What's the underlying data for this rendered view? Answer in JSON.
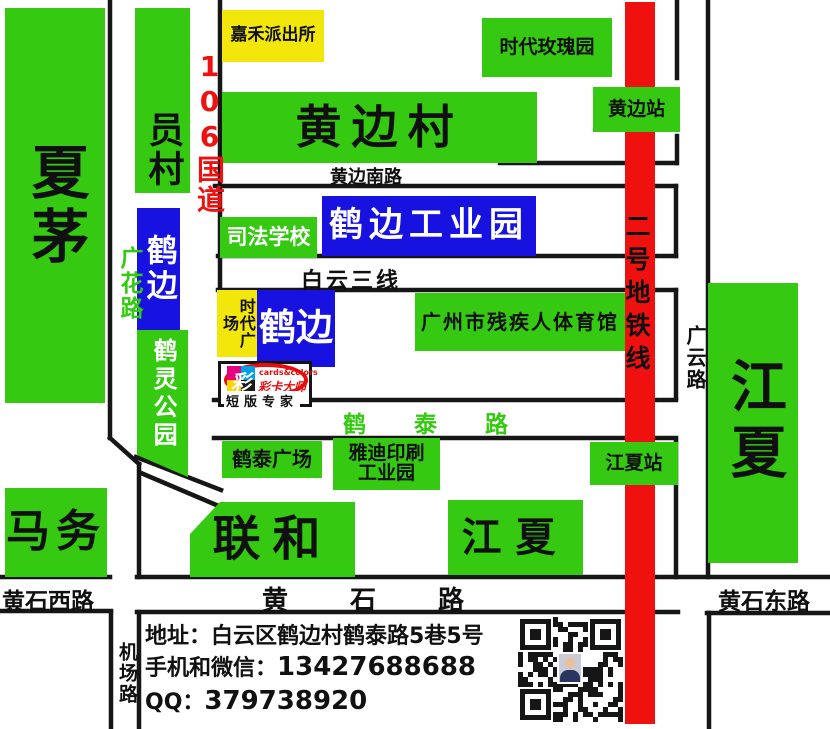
{
  "palette": {
    "green": "#35c912",
    "yellow": "#f2e60a",
    "blue": "#1712e0",
    "red": "#ef1010",
    "road": "#161616"
  },
  "places": {
    "xiamao": "夏茅",
    "yuancun": "员村",
    "jiahe_police_station": "嘉禾派出所",
    "huangbian_village": "黄边村",
    "times_rose_garden": "时代玫瑰园",
    "hebian_industrial_park": "鹤边工业园",
    "judicial_school": "司法学校",
    "hebian_west": "鹤边",
    "times_plaza": "时代广场",
    "hebian": "鹤边",
    "heling_park": "鹤灵公园",
    "gz_disabled_sports_center": "广州市残疾人体育馆",
    "hetai_plaza": "鹤泰广场",
    "yadi_printing_park_line1": "雅迪印刷",
    "yadi_printing_park_line2": "工业园",
    "mawu": "马务",
    "lianhe": "联和",
    "jiangxia_town": "江夏",
    "jiangxia_east": "江夏"
  },
  "roads": {
    "g106": "106国道",
    "guanghua_road": "广花路",
    "huangbian_south_road": "黄边南路",
    "baiyun_third_line": "白云三线",
    "hetai_road": "鹤泰路",
    "huangshi_road": "黄石路",
    "huangshi_west_road": "黄石西路",
    "huangshi_east_road": "黄石东路",
    "guangyun_road": "广云路",
    "airport_road": "机场路"
  },
  "metro": {
    "line_label": "二号地铁线",
    "stations": {
      "huangbian": "黄边站",
      "jiangxia": "江夏站"
    }
  },
  "logo": {
    "mark_char": "彩",
    "brand_en": "cards&colors",
    "brand_cn": "彩卡大师",
    "tagline": "短版专家"
  },
  "contact": {
    "address_label": "地址：",
    "address": "白云区鹤边村鹤泰路5巷5号",
    "phone_label": "手机和微信：",
    "phone": "13427688688",
    "qq_label": "QQ：",
    "qq": "379738920"
  }
}
